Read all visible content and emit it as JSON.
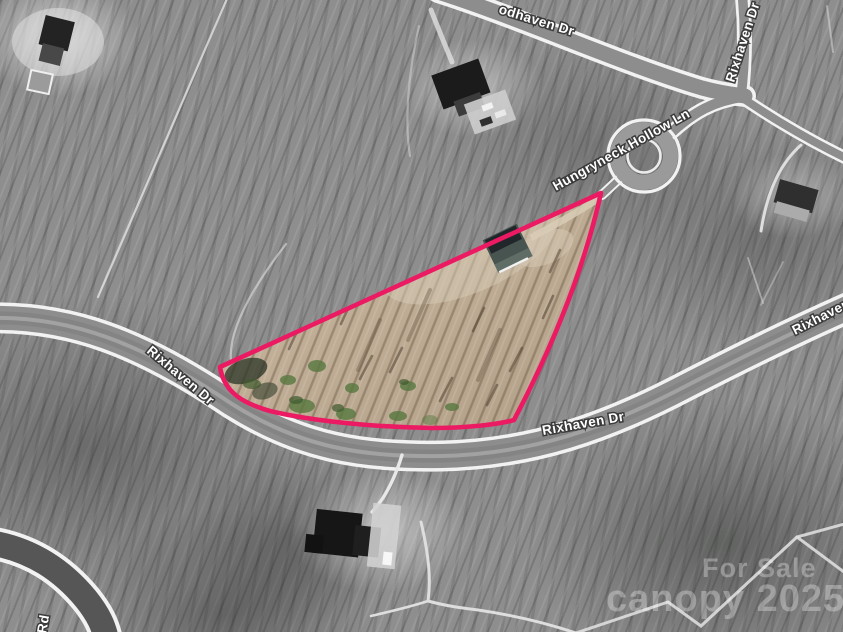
{
  "map": {
    "street_labels": [
      {
        "id": "odhaven-dr-top",
        "text": "odhaven Dr"
      },
      {
        "id": "rixhaven-dr-top-right",
        "text": "Rixhaven Dr"
      },
      {
        "id": "hungryneck-hollow-ln",
        "text": "Hungryneck Hollow Ln"
      },
      {
        "id": "rixhaven-dr-left",
        "text": "Rixhaven Dr"
      },
      {
        "id": "rixhaven-dr-bottom",
        "text": "Rixhaven Dr"
      },
      {
        "id": "rixhaven-dr-right-edge",
        "text": "Rixhaven Dr"
      },
      {
        "id": "rd-partial-bottom-left",
        "text": "Rd"
      }
    ],
    "watermark": {
      "line1": "For Sale",
      "line2": "canopy 2025"
    },
    "parcel": {
      "outline_color": "#ec1a63",
      "ground_color": "#bfac94"
    },
    "colors": {
      "label_text": "#ffffff",
      "label_halo": "#3b3b3b",
      "road_casing": "#f2f2f2",
      "road_fill": "#8d8d8d"
    }
  }
}
